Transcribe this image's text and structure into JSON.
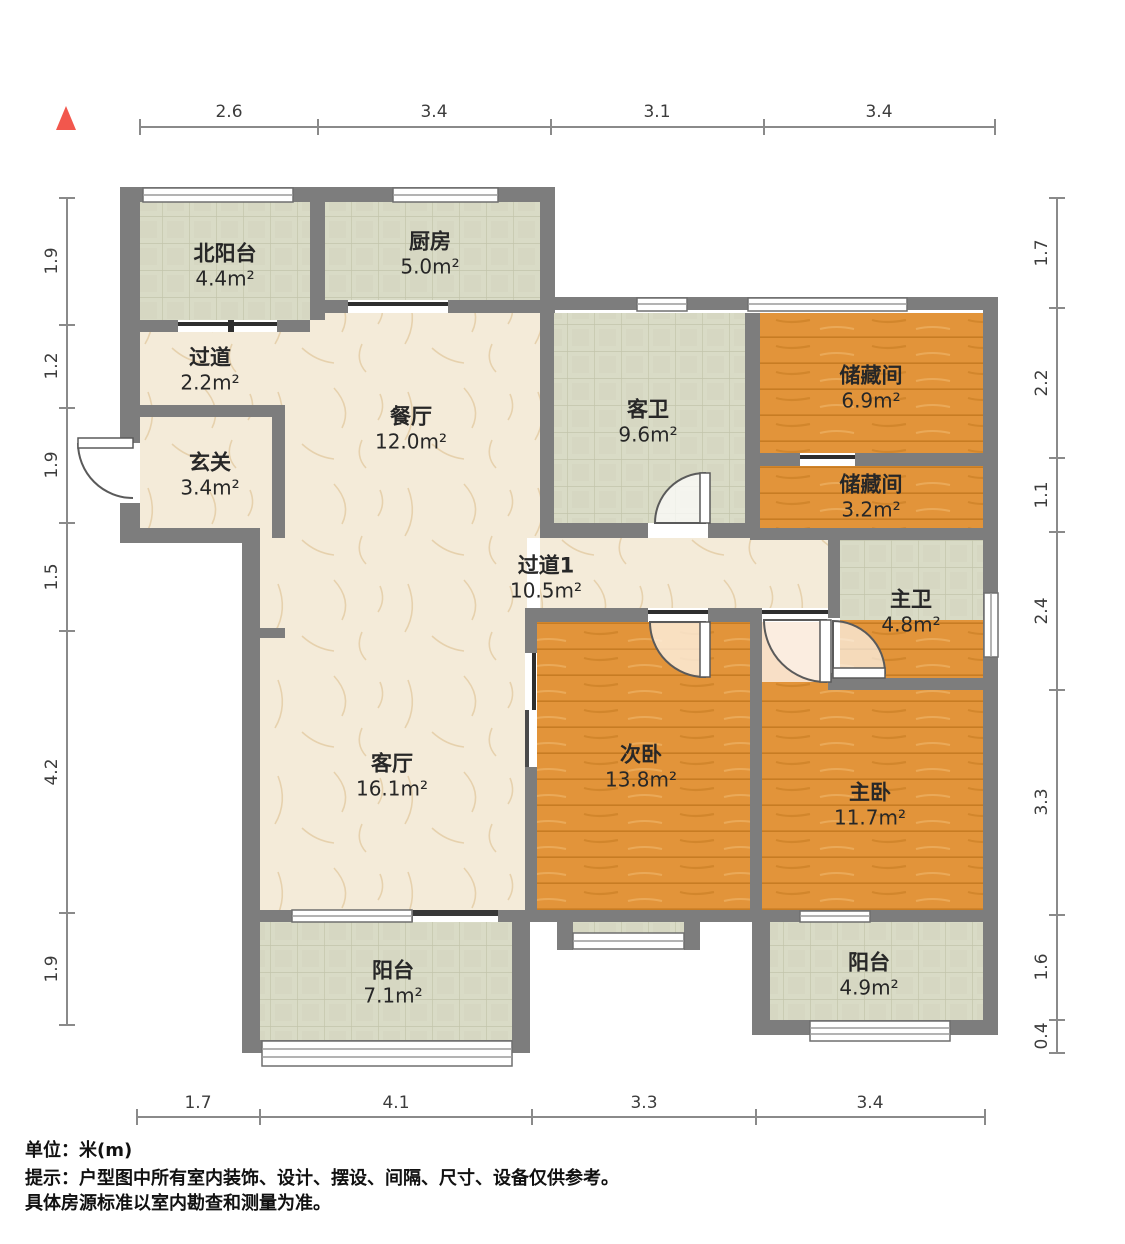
{
  "title": "户型图 (floor plan)",
  "rooms": [
    {
      "name": "北阳台",
      "area": "4.4m²"
    },
    {
      "name": "厨房",
      "area": "5.0m²"
    },
    {
      "name": "过道",
      "area": "2.2m²"
    },
    {
      "name": "玄关",
      "area": "3.4m²"
    },
    {
      "name": "餐厅",
      "area": "12.0m²"
    },
    {
      "name": "客卫",
      "area": "9.6m²"
    },
    {
      "name": "储藏间",
      "area": "6.9m²"
    },
    {
      "name": "储藏间",
      "area": "3.2m²"
    },
    {
      "name": "主卫",
      "area": "4.8m²"
    },
    {
      "name": "过道1",
      "area": "10.5m²"
    },
    {
      "name": "次卧",
      "area": "13.8m²"
    },
    {
      "name": "主卧",
      "area": "11.7m²"
    },
    {
      "name": "客厅",
      "area": "16.1m²"
    },
    {
      "name": "阳台",
      "area": "7.1m²"
    },
    {
      "name": "阳台",
      "area": "4.9m²"
    }
  ],
  "dims": {
    "top": [
      "2.6",
      "3.4",
      "3.1",
      "3.4"
    ],
    "bottom": [
      "1.7",
      "4.1",
      "3.3",
      "3.4"
    ],
    "left": [
      "1.9",
      "1.2",
      "1.9",
      "1.5",
      "4.2",
      "1.9"
    ],
    "right": [
      "1.7",
      "2.2",
      "1.1",
      "2.4",
      "3.3",
      "1.6",
      "0.4"
    ]
  },
  "footer": {
    "unit": "单位：米(m)",
    "tip1": "提示：户型图中所有室内装饰、设计、摆设、间隔、尺寸、设备仅供参考。",
    "tip2": "具体房源标准以室内勘查和测量为准。"
  },
  "colors": {
    "wall": "#7d7d7d",
    "wood_floor": "#e2943a",
    "tile_floor": "#d9dbc6",
    "marble_floor": "#f4ebd9",
    "north_marker": "#f2574d",
    "dimension_line": "#8a8a8a"
  }
}
